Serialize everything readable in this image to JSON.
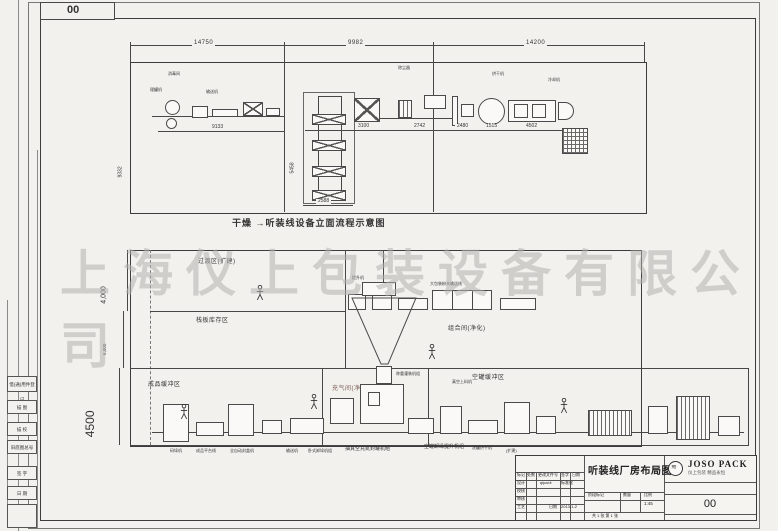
{
  "frame": {
    "rev_box": "00",
    "margin_labels": [
      "借(通)用件登记",
      "描 图",
      "描 校",
      "旧底图总号",
      "签 字",
      "日 期"
    ]
  },
  "watermark": "上海仪上包装设备有限公司",
  "top_drawing": {
    "caption": "干燥 →听装线设备立面流程示意图",
    "dims_top": [
      "14750",
      "9982",
      "14200"
    ],
    "dim_left": "9332",
    "dim_9133": "9133",
    "dim_5458": "5458",
    "dim_2588": "2588",
    "dim_3100": "3100",
    "dim_2742": "2742",
    "dim_2480": "2480",
    "dim_1515": "1515",
    "dim_4502": "4502",
    "labels": [
      "消毒间",
      "理罐机",
      "输送机",
      "除尘器",
      "烘干机",
      "冷却机"
    ]
  },
  "layout_drawing": {
    "zone_transition": "过渡区(扩建)",
    "zone_combination": "组合间(净化)",
    "zone_pallet": "栈板库存区",
    "zone_finished": "成品缓冲区",
    "zone_gas": "充气间(净化)",
    "zone_empty_can": "空罐缓冲区",
    "dim_4000": "4,000",
    "dim_6000": "6,000",
    "dim_4500": "4500",
    "machine_labels": [
      "提升机",
      "大包装粉末输送线",
      "称重灌装机组",
      "真空上料机"
    ],
    "bottom_labels": [
      "码垛机",
      "成品平台线",
      "全自动封盖机",
      "输送机",
      "卧式卸垛机组",
      "抽真空充氮封罐机组",
      "空罐卸垛提升机组",
      "洗罐烘干机",
      "(扩建)"
    ]
  },
  "title_block": {
    "title": "听装线厂房布局图",
    "brand": "JOSO PACK",
    "brand_sub": "仪上包装 精品永恒",
    "drawing_no": "00",
    "header_cells": [
      "标记",
      "处数",
      "更改文件号",
      "签字",
      "日期"
    ],
    "row_design": "设计",
    "row_check": "校核",
    "row_audit": "审核",
    "row_process": "工艺",
    "sig": "qipack",
    "std_label": "标准化",
    "date_label": "日期",
    "date": "2013-1-2",
    "stage_label": "阶段标记",
    "qty_label": "数量",
    "scale_label": "比例",
    "scale": "1:45",
    "sheets": "共 1 张 第 1 张"
  }
}
